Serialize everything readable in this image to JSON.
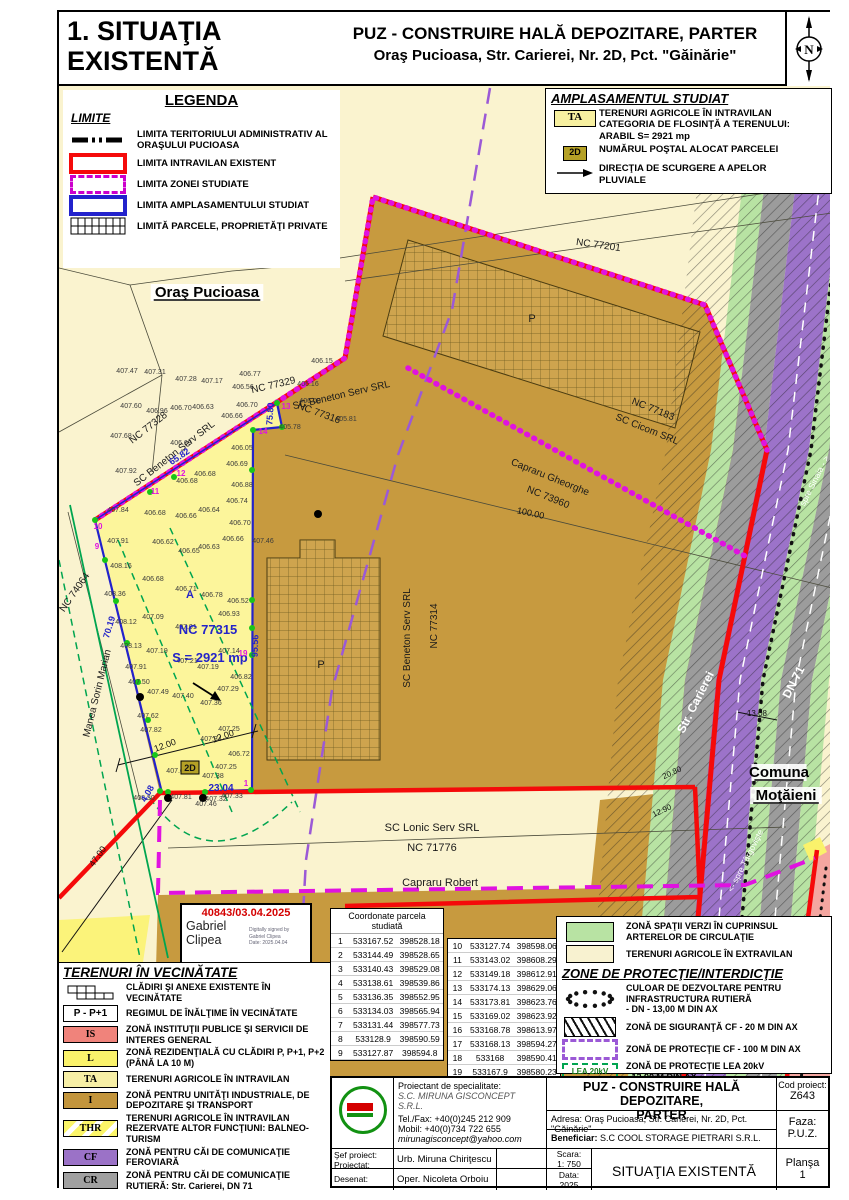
{
  "header": {
    "sheet1": "1. SITUAŢIA",
    "sheet2": "EXISTENTĂ",
    "line1": "PUZ - CONSTRUIRE HALĂ DEPOZITARE, PARTER",
    "line2": "Oraş Pucioasa, Str. Carierei, Nr. 2D, Pct. \"Găinărie\"",
    "north": "N"
  },
  "legenda": {
    "title": "LEGENDA",
    "subtitle": "LIMITE",
    "items": [
      {
        "type": "dashdot",
        "label": "LIMITA TERITORIULUI ADMINISTRATIV AL ORAŞULUI PUCIOASA"
      },
      {
        "type": "redrect",
        "label": "LIMITA INTRAVILAN EXISTENT"
      },
      {
        "type": "magdash",
        "label": "LIMITA ZONEI STUDIATE"
      },
      {
        "type": "bluerect",
        "label": "LIMITA AMPLASAMENTULUI STUDIAT"
      },
      {
        "type": "grid",
        "label": "LIMITĂ PARCELE, PROPRIETĂŢI PRIVATE"
      }
    ]
  },
  "ampl": {
    "title": "AMPLASAMENTUL STUDIAT",
    "ta_badge": "TA",
    "ta_lines": [
      "TERENURI AGRICOLE ÎN INTRAVILAN",
      "CATEGORIA DE FLOSINŢĂ A TERENULUI:",
      "ARABIL        S= 2921 mp"
    ],
    "badge": "2D",
    "badge_text": "NUMĂRUL POŞTAL ALOCAT PARCELEI",
    "arrow_lines": [
      "DIRECŢIA DE SCURGERE A APELOR",
      "PLUVIALE"
    ]
  },
  "vecin": {
    "title": "TERENURI ÎN VECINĂTATE",
    "items": [
      {
        "type": "buildings",
        "label": "CLĂDIRI ŞI ANEXE EXISTENTE  ÎN VECINĂTATE"
      },
      {
        "type": "badge",
        "badge": "P - P+1",
        "label": "REGIMUL DE ÎNĂLŢIME ÎN VECINĂTATE"
      },
      {
        "type": "color",
        "badge": "IS",
        "color": "#F0837B",
        "label": "ZONĂ INSTITUŢII PUBLICE ŞI SERVICII DE INTERES GENERAL"
      },
      {
        "type": "color",
        "badge": "L",
        "color": "#FAF26B",
        "label": "ZONĂ REZIDENŢIALĂ CU CLĂDIRI P, P+1, P+2 (PÂNĂ LA 10 M)"
      },
      {
        "type": "color",
        "badge": "TA",
        "color": "#F7EFA6",
        "label": "TERENURI AGRICOLE ÎN INTRAVILAN"
      },
      {
        "type": "color",
        "badge": "I",
        "color": "#C3953C",
        "label": "ZONĂ PENTRU UNITĂŢI INDUSTRIALE, DE DEPOZITARE ŞI TRANSPORT"
      },
      {
        "type": "thr",
        "badge": "THR",
        "color": "#FBF568",
        "label": "TERENURI AGRICOLE ÎN INTRAVILAN REZERVATE ALTOR FUNCŢIUNI: BALNEO-TURISM"
      },
      {
        "type": "color",
        "badge": "CF",
        "color": "#9B72C7",
        "label": "ZONĂ PENTRU CĂI DE COMUNICAŢIE FEROVIARĂ"
      },
      {
        "type": "color",
        "badge": "CR",
        "color": "#A0A0A0",
        "label": "ZONĂ PENTRU CĂI DE COMUNICAŢIE RUTIERĂ: Str. Carierei, DN 71"
      }
    ]
  },
  "zone": {
    "green_label": "ZONĂ SPAŢII VERZI ÎN CUPRINSUL ARTERELOR DE CIRCULAŢIE",
    "cream_label": "TERENURI AGRICOLE ÎN EXTRAVILAN",
    "title": "ZONE DE PROTECŢIE/INTERDICŢIE",
    "items": [
      {
        "type": "dots",
        "label": "CULOAR DE DEZVOLTARE PENTRU INFRASTRUCTURA RUTIERĂ\n- DN - 13,00 M DIN AX"
      },
      {
        "type": "hatch",
        "label": "ZONĂ DE SIGURANŢĂ CF - 20 M DIN AX"
      },
      {
        "type": "pdash",
        "label": "ZONĂ DE PROTECŢIE CF - 100 M DIN AX"
      },
      {
        "type": "lea",
        "badge": "LEA 20kV",
        "label": "ZONĂ DE PROTECŢIE LEA 20kV\n- 12,00 M DIN AX"
      }
    ]
  },
  "coords": {
    "title": "Coordonate parcela studiată",
    "rows": [
      [
        "1",
        "533167.52",
        "398528.18"
      ],
      [
        "2",
        "533144.49",
        "398528.65"
      ],
      [
        "3",
        "533140.43",
        "398529.08"
      ],
      [
        "4",
        "533138.61",
        "398539.86"
      ],
      [
        "5",
        "533136.35",
        "398552.95"
      ],
      [
        "6",
        "533134.03",
        "398565.94"
      ],
      [
        "7",
        "533131.44",
        "398577.73"
      ],
      [
        "8",
        "533128.9",
        "398590.59"
      ],
      [
        "9",
        "533127.87",
        "398594.8"
      ],
      [
        "10",
        "533127.74",
        "398598.06"
      ],
      [
        "11",
        "533143.02",
        "398608.29"
      ],
      [
        "12",
        "533149.18",
        "398612.91"
      ],
      [
        "13",
        "533174.13",
        "398629.06"
      ],
      [
        "14",
        "533173.81",
        "398623.76"
      ],
      [
        "15",
        "533169.02",
        "398623.92"
      ],
      [
        "16",
        "533168.78",
        "398613.97"
      ],
      [
        "17",
        "533168.13",
        "398594.27"
      ],
      [
        "18",
        "533168",
        "398590.41"
      ],
      [
        "19",
        "533167.9",
        "398580.23"
      ]
    ]
  },
  "stamp": {
    "number": "40843/03.04.2025",
    "name1": "Gabriel",
    "name2": "Clipea",
    "sig1": "Digitally signed by",
    "sig2": "Gabriel Clipea",
    "sig3": "Date: 2025.04.04"
  },
  "tb": {
    "proiectant_label": "Proiectant de specialitate:",
    "proiectant": "S.C. MIRUNA GISCONCEPT S.R.L.",
    "tel": "Tel./Fax: +40(0)245 212 909",
    "mobil": "Mobil: +40(0)734 722 655",
    "email": "mirunagisconcept@yahoo.com",
    "sef_label": "Şef proiect:",
    "proiectat_label": "Proiectat:",
    "sef_name": "Urb. Miruna Chiriţescu",
    "desenat_label": "Desenat:",
    "desenat_name": "Oper. Nicoleta Orboiu",
    "title1": "PUZ - CONSTRUIRE HALĂ DEPOZITARE,",
    "title2": "PARTER",
    "adresa_label": "Adresa:",
    "adresa": "Oraş Pucioasa, Str. Carierei, Nr. 2D, Pct. \"Găinărie\"",
    "beneficiar_label": "Beneficiar:",
    "beneficiar": "S.C COOL STORAGE PIETRARI S.R.L.",
    "scara_label": "Scara:",
    "scara": "1: 750",
    "data_label": "Data:",
    "data": "2025",
    "plan_title": "SITUAŢIA EXISTENTĂ",
    "cod_label": "Cod proiect:",
    "cod": "Z643",
    "faza_label": "Faza:",
    "faza": "P.U.Z.",
    "plansa_label": "Planşa",
    "plansa": "1"
  },
  "map": {
    "labels": [
      {
        "t": "Oraş Pucioasa",
        "x": 207,
        "y": 297,
        "c": "pl",
        "bg": 1,
        "u": 1
      },
      {
        "t": "Comuna",
        "x": 779,
        "y": 777,
        "c": "pl",
        "bg": 1,
        "u": 1
      },
      {
        "t": "Moţăieni",
        "x": 786,
        "y": 800,
        "c": "pl",
        "bg": 1,
        "u": 1
      },
      {
        "t": "NC 77201",
        "x": 598,
        "y": 248,
        "r": 8,
        "c": "nc"
      },
      {
        "t": "NC 77183",
        "x": 652,
        "y": 412,
        "r": 22,
        "c": "nc"
      },
      {
        "t": "SC Cicom SRL",
        "x": 646,
        "y": 432,
        "r": 22,
        "c": "nc"
      },
      {
        "t": "Capraru Gheorghe",
        "x": 549,
        "y": 480,
        "r": 22,
        "c": "nc"
      },
      {
        "t": "NC 73960",
        "x": 547,
        "y": 500,
        "r": 22,
        "c": "nc"
      },
      {
        "t": "100.00",
        "x": 530,
        "y": 516,
        "r": 12,
        "c": "dim"
      },
      {
        "t": "NC 77328",
        "x": 150,
        "y": 430,
        "r": -38,
        "c": "nc"
      },
      {
        "t": "SC Beneton Serv SRL",
        "x": 176,
        "y": 456,
        "r": -38,
        "c": "nc"
      },
      {
        "t": "NC 77329",
        "x": 274,
        "y": 388,
        "r": -13,
        "c": "nc"
      },
      {
        "t": "SC Beneton Serv SRL",
        "x": 342,
        "y": 398,
        "r": -13,
        "c": "nc"
      },
      {
        "t": "NC 77316",
        "x": 318,
        "y": 416,
        "r": 20,
        "c": "nc"
      },
      {
        "t": "NC 77315",
        "x": 208,
        "y": 634,
        "c": "ncb",
        "s": 13
      },
      {
        "t": "S = 2921 mp",
        "x": 210,
        "y": 662,
        "c": "ncb",
        "s": 13
      },
      {
        "t": "A",
        "x": 190,
        "y": 598,
        "c": "ncb",
        "s": 11
      },
      {
        "t": "NC 77314",
        "x": 437,
        "y": 626,
        "r": -90,
        "c": "nc"
      },
      {
        "t": "SC Beneton Serv SRL",
        "x": 410,
        "y": 638,
        "r": -90,
        "c": "nc"
      },
      {
        "t": "NC 74064",
        "x": 77,
        "y": 594,
        "r": -55,
        "c": "nc"
      },
      {
        "t": "Manea Sorin Marian",
        "x": 100,
        "y": 694,
        "r": -76,
        "c": "nc"
      },
      {
        "t": "SC Lonic Serv SRL",
        "x": 432,
        "y": 831,
        "c": "nc",
        "s": 11
      },
      {
        "t": "NC 71776",
        "x": 432,
        "y": 851,
        "c": "nc",
        "s": 11
      },
      {
        "t": "Capraru Robert",
        "x": 440,
        "y": 886,
        "c": "nc",
        "s": 11
      },
      {
        "t": "Str. Carierei",
        "x": 699,
        "y": 704,
        "r": -63,
        "c": "wh"
      },
      {
        "t": "DN 71",
        "x": 797,
        "y": 684,
        "r": -63,
        "c": "wh"
      },
      {
        "t": "spre Sinaia - >",
        "x": 817,
        "y": 482,
        "r": -63,
        "c": "whs"
      },
      {
        "t": "<- spre Târgovişte",
        "x": 748,
        "y": 862,
        "r": -63,
        "c": "whs"
      },
      {
        "t": "P",
        "x": 532,
        "y": 322,
        "c": "nc",
        "s": 11
      },
      {
        "t": "P",
        "x": 321,
        "y": 668,
        "c": "nc",
        "s": 11
      },
      {
        "t": "12.00",
        "x": 166,
        "y": 748,
        "r": -20,
        "c": "dim"
      },
      {
        "t": "12.00",
        "x": 224,
        "y": 739,
        "r": -20,
        "c": "dim"
      },
      {
        "t": "47.00",
        "x": 100,
        "y": 858,
        "r": -55,
        "c": "dim"
      },
      {
        "t": "13.08",
        "x": 757,
        "y": 716,
        "c": "dim",
        "s": 8
      },
      {
        "t": "20.80",
        "x": 673,
        "y": 775,
        "r": -25,
        "c": "dim",
        "s": 8
      },
      {
        "t": "12.90",
        "x": 663,
        "y": 813,
        "r": -25,
        "c": "dim",
        "s": 8
      },
      {
        "t": "70.19",
        "x": 112,
        "y": 628,
        "r": -73,
        "c": "blue"
      },
      {
        "t": "95.56",
        "x": 258,
        "y": 646,
        "r": -88,
        "c": "blue"
      },
      {
        "t": "65.82",
        "x": 181,
        "y": 459,
        "r": -34,
        "c": "blue"
      },
      {
        "t": "75.80",
        "x": 273,
        "y": 414,
        "r": -86,
        "c": "blue"
      },
      {
        "t": "23.04",
        "x": 221,
        "y": 791,
        "c": "blue",
        "s": 10
      },
      {
        "t": "4.08",
        "x": 150,
        "y": 795,
        "r": -60,
        "c": "blue"
      },
      {
        "t": "2D",
        "x": 190,
        "y": 771,
        "c": "badge"
      },
      {
        "t": "1",
        "x": 246,
        "y": 786,
        "c": "vx"
      },
      {
        "t": "9",
        "x": 97,
        "y": 549,
        "c": "vx"
      },
      {
        "t": "10",
        "x": 98,
        "y": 529,
        "c": "vx"
      },
      {
        "t": "11",
        "x": 155,
        "y": 494,
        "c": "vx"
      },
      {
        "t": "12",
        "x": 181,
        "y": 476,
        "c": "vx"
      },
      {
        "t": "13",
        "x": 286,
        "y": 409,
        "c": "vx"
      },
      {
        "t": "14",
        "x": 263,
        "y": 434,
        "c": "vx"
      },
      {
        "t": "19",
        "x": 243,
        "y": 656,
        "c": "vx"
      }
    ],
    "spots": [
      [
        127,
        373,
        "407.47"
      ],
      [
        155,
        374,
        "407.31"
      ],
      [
        186,
        381,
        "407.28"
      ],
      [
        212,
        383,
        "407.17"
      ],
      [
        250,
        376,
        "406.77"
      ],
      [
        243,
        389,
        "406.56"
      ],
      [
        308,
        386,
        "406.16"
      ],
      [
        322,
        363,
        "406.15"
      ],
      [
        131,
        408,
        "407.60"
      ],
      [
        157,
        413,
        "406.96"
      ],
      [
        181,
        410,
        "406.70"
      ],
      [
        203,
        409,
        "406.63"
      ],
      [
        247,
        407,
        "406.70"
      ],
      [
        310,
        403,
        "406.00"
      ],
      [
        346,
        421,
        "405.81"
      ],
      [
        290,
        429,
        "405.78"
      ],
      [
        232,
        418,
        "406.66"
      ],
      [
        181,
        445,
        "406.69"
      ],
      [
        121,
        438,
        "407.68"
      ],
      [
        126,
        473,
        "407.92"
      ],
      [
        205,
        476,
        "406.68"
      ],
      [
        187,
        483,
        "406.68"
      ],
      [
        118,
        512,
        "407.84"
      ],
      [
        155,
        515,
        "406.68"
      ],
      [
        186,
        518,
        "406.66"
      ],
      [
        209,
        512,
        "406.64"
      ],
      [
        118,
        543,
        "407.91"
      ],
      [
        163,
        544,
        "406.62"
      ],
      [
        209,
        549,
        "406.63"
      ],
      [
        189,
        553,
        "406.65"
      ],
      [
        121,
        568,
        "408.16"
      ],
      [
        153,
        581,
        "406.68"
      ],
      [
        186,
        591,
        "406.71"
      ],
      [
        212,
        597,
        "406.78"
      ],
      [
        242,
        450,
        "406.05"
      ],
      [
        237,
        466,
        "406.69"
      ],
      [
        242,
        487,
        "406.88"
      ],
      [
        237,
        503,
        "406.74"
      ],
      [
        240,
        525,
        "406.70"
      ],
      [
        233,
        541,
        "406.66"
      ],
      [
        263,
        543,
        "407.46"
      ],
      [
        115,
        596,
        "408.36"
      ],
      [
        153,
        619,
        "407.09"
      ],
      [
        126,
        624,
        "408.12"
      ],
      [
        229,
        616,
        "406.93"
      ],
      [
        186,
        629,
        "407.01"
      ],
      [
        131,
        648,
        "408.13"
      ],
      [
        157,
        653,
        "407.19"
      ],
      [
        229,
        653,
        "407.14"
      ],
      [
        187,
        663,
        "407.21"
      ],
      [
        208,
        669,
        "407.19"
      ],
      [
        136,
        669,
        "407.91"
      ],
      [
        241,
        679,
        "406.82"
      ],
      [
        139,
        684,
        "407.50"
      ],
      [
        158,
        694,
        "407.49"
      ],
      [
        228,
        691,
        "407.29"
      ],
      [
        183,
        698,
        "407.40"
      ],
      [
        211,
        705,
        "407.36"
      ],
      [
        148,
        718,
        "407.62"
      ],
      [
        229,
        731,
        "407.25"
      ],
      [
        151,
        732,
        "407.82"
      ],
      [
        211,
        741,
        "407.34"
      ],
      [
        239,
        756,
        "406.72"
      ],
      [
        226,
        769,
        "407.25"
      ],
      [
        177,
        773,
        "407.66"
      ],
      [
        213,
        778,
        "407.38"
      ],
      [
        144,
        800,
        "408.30"
      ],
      [
        181,
        799,
        "407.81"
      ],
      [
        216,
        801,
        "407.32"
      ],
      [
        232,
        798,
        "407.33"
      ],
      [
        206,
        806,
        "407.46"
      ],
      [
        238,
        603,
        "406.52"
      ]
    ]
  },
  "colors": {
    "red": "#F50A0A",
    "magenta": "#E012E0",
    "blue": "#2222CC",
    "purple": "#9B59D6",
    "lea_green": "#00A550",
    "tan": "#C79A3F",
    "parcel_yellow": "#FCF59B",
    "cream": "#FAF3CF",
    "band_green": "#B8E3A3",
    "band_gray": "#9C9C9C",
    "band_purple": "#9C73C9",
    "pink": "#F4A6A0"
  }
}
